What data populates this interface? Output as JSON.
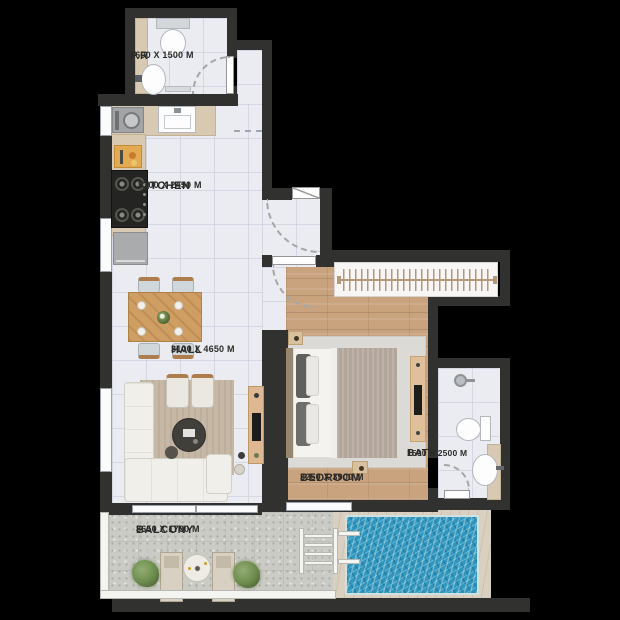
{
  "floorplan": {
    "rooms": [
      {
        "id": "pr",
        "label": "P.R",
        "dimensions": "1600 X 1500 M"
      },
      {
        "id": "kitchen",
        "label": "KITCHEN",
        "dimensions": "3100 X 2450 M"
      },
      {
        "id": "hall",
        "label": "HALL",
        "dimensions": "3100 X 4650 M"
      },
      {
        "id": "bedroom",
        "label": "BEDROOM",
        "dimensions": "3250 X 3900 M"
      },
      {
        "id": "bath",
        "label": "BATH",
        "dimensions": "1500 X 2500 M"
      },
      {
        "id": "balcony",
        "label": "BALCONY",
        "dimensions": "8650 X 1700 M"
      }
    ],
    "colors": {
      "background": "#000000",
      "walls": "#31312f",
      "tile_floor": "#eaecf2",
      "wood_floor": "#c8a37e",
      "balcony_floor": "#cbcbc6",
      "pool_water": "#2f96bd",
      "pool_deck": "#d9d0c2",
      "counter": "#d8cab2",
      "rug": "#c6b8a5",
      "label_text": "#2b2b29"
    },
    "icons": [
      "toilet",
      "washbasin",
      "kitchen-sink",
      "stove",
      "refrigerator",
      "washing-machine",
      "cutting-board",
      "dining-table",
      "dining-chair",
      "sofa",
      "armchair",
      "coffee-table",
      "tv-console",
      "bed",
      "nightstand",
      "wardrobe",
      "dresser-tv",
      "shower-head",
      "door-arc",
      "pool",
      "pool-ladder",
      "lounge-chair",
      "round-table",
      "plant",
      "window",
      "sliding-door"
    ]
  }
}
